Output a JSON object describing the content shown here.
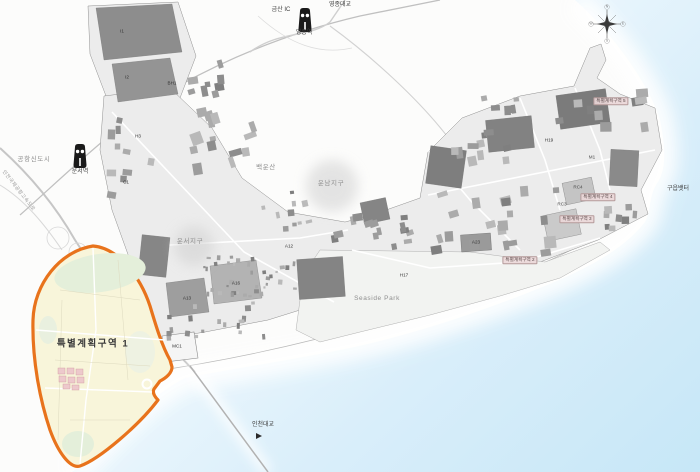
{
  "map": {
    "colors": {
      "sea_deep": "#c7e7f7",
      "sea_shallow": "#eef8fd",
      "land": "#fcfcfb",
      "urban_base": "#ececec",
      "block_dark": "#7f7f7f",
      "block_mid": "#a6a6a6",
      "district1_fill": "#f8f5da",
      "district1_stroke": "#e8731c",
      "district_green": "#e4efda",
      "district_pink": "#edc9cc"
    },
    "labels": [
      {
        "text": "금산 IC",
        "x": 281,
        "y": 10,
        "cls": "place"
      },
      {
        "text": "영종대교",
        "x": 340,
        "y": 5,
        "cls": "place"
      },
      {
        "text": "영종역",
        "x": 304,
        "y": 33,
        "cls": "place"
      },
      {
        "text": "공항신도시",
        "x": 34,
        "y": 160,
        "cls": "region"
      },
      {
        "text": "운서역",
        "x": 80,
        "y": 172,
        "cls": "place"
      },
      {
        "text": "인천국제공항고속도로",
        "x": 18,
        "y": 191,
        "cls": "place-sm",
        "rot": 52
      },
      {
        "text": "백운산",
        "x": 266,
        "y": 168,
        "cls": "region"
      },
      {
        "text": "운남지구",
        "x": 331,
        "y": 184,
        "cls": "region"
      },
      {
        "text": "운서지구",
        "x": 190,
        "y": 242,
        "cls": "region"
      },
      {
        "text": "Seaside Park",
        "x": 377,
        "y": 299,
        "cls": "region"
      },
      {
        "text": "인천대교",
        "x": 263,
        "y": 425,
        "cls": "place"
      },
      {
        "text": "구읍뱃터",
        "x": 678,
        "y": 189,
        "cls": "place"
      },
      {
        "text": "특별계획구역 1",
        "x": 93,
        "y": 344,
        "cls": "district-title"
      },
      {
        "text": "특별계획구역 2",
        "x": 520,
        "y": 260,
        "cls": "district-tag"
      },
      {
        "text": "특별계획구역 3",
        "x": 577,
        "y": 219,
        "cls": "district-tag"
      },
      {
        "text": "특별계획구역 4",
        "x": 598,
        "y": 197,
        "cls": "district-tag"
      },
      {
        "text": "특별계획구역 5",
        "x": 611,
        "y": 101,
        "cls": "district-tag"
      },
      {
        "text": "I1",
        "x": 122,
        "y": 32,
        "cls": "block"
      },
      {
        "text": "I2",
        "x": 127,
        "y": 78,
        "cls": "block"
      },
      {
        "text": "BH1",
        "x": 172,
        "y": 84,
        "cls": "block"
      },
      {
        "text": "H3",
        "x": 138,
        "y": 137,
        "cls": "block"
      },
      {
        "text": "C1",
        "x": 126,
        "y": 183,
        "cls": "block"
      },
      {
        "text": "A13",
        "x": 187,
        "y": 299,
        "cls": "block"
      },
      {
        "text": "A16",
        "x": 236,
        "y": 284,
        "cls": "block"
      },
      {
        "text": "A12",
        "x": 289,
        "y": 247,
        "cls": "block"
      },
      {
        "text": "MC1",
        "x": 177,
        "y": 347,
        "cls": "block"
      },
      {
        "text": "H17",
        "x": 404,
        "y": 276,
        "cls": "block"
      },
      {
        "text": "A23",
        "x": 476,
        "y": 243,
        "cls": "block"
      },
      {
        "text": "H19",
        "x": 549,
        "y": 141,
        "cls": "block"
      },
      {
        "text": "M1",
        "x": 592,
        "y": 158,
        "cls": "block-lt"
      },
      {
        "text": "RC4",
        "x": 578,
        "y": 188,
        "cls": "block-lt"
      },
      {
        "text": "RC3",
        "x": 562,
        "y": 205,
        "cls": "block-lt"
      },
      {
        "text": "N",
        "x": 607,
        "y": 7,
        "cls": "compass-pt"
      },
      {
        "text": "E",
        "x": 623,
        "y": 24,
        "cls": "compass-pt"
      },
      {
        "text": "S",
        "x": 607,
        "y": 41,
        "cls": "compass-pt"
      },
      {
        "text": "W",
        "x": 591,
        "y": 24,
        "cls": "compass-pt"
      }
    ],
    "stations": [
      {
        "name": "영종역"
      },
      {
        "name": "운서역"
      }
    ]
  }
}
